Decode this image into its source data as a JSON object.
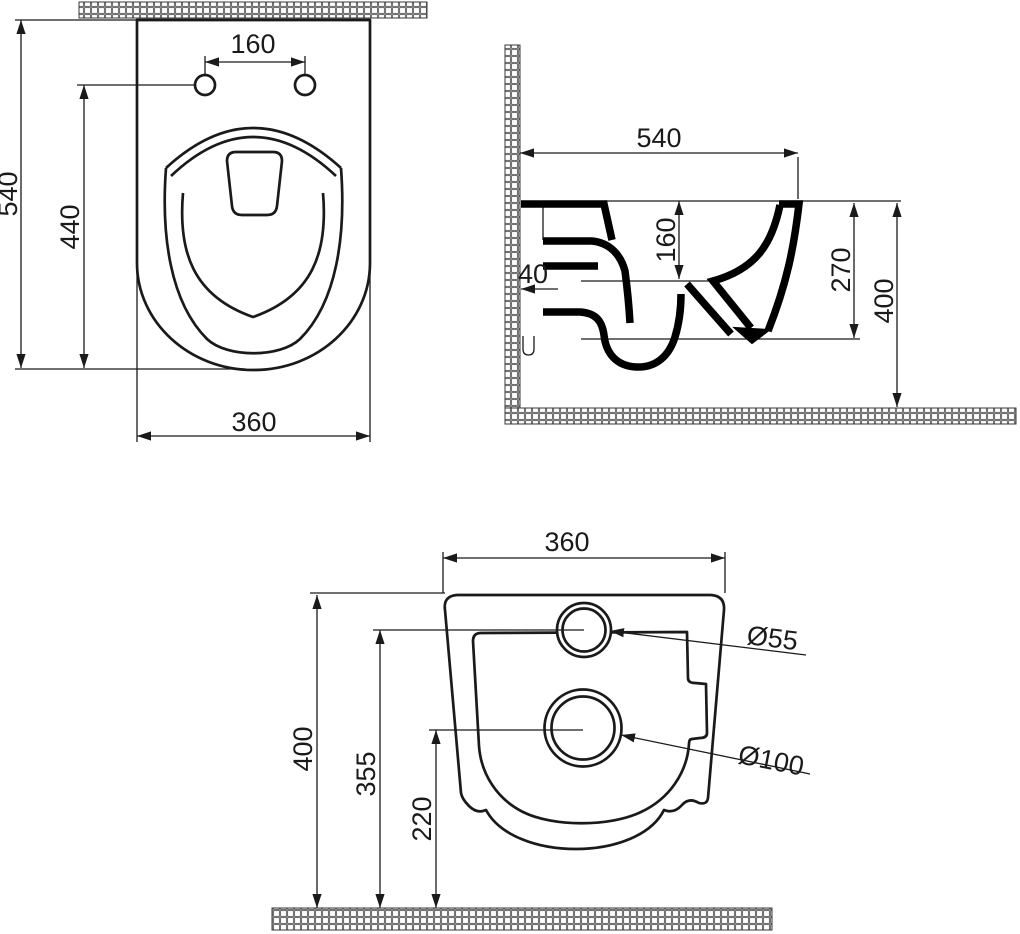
{
  "colors": {
    "line_color": "#1a1a1a",
    "background": "#ffffff"
  },
  "views": {
    "top": {
      "label_overall_length": "540",
      "label_hole_to_front": "440",
      "label_hole_spacing": "160",
      "label_width": "360"
    },
    "side": {
      "label_depth": "540",
      "label_rim_drop": "160",
      "label_wall_offset": "40",
      "label_outlet_height": "270",
      "label_overall_height": "400"
    },
    "rear": {
      "label_width": "360",
      "label_overall_height": "400",
      "label_inlet_height": "355",
      "label_outlet_height": "220",
      "label_inlet_diameter": "Ø55",
      "label_outlet_diameter": "Ø100"
    }
  }
}
